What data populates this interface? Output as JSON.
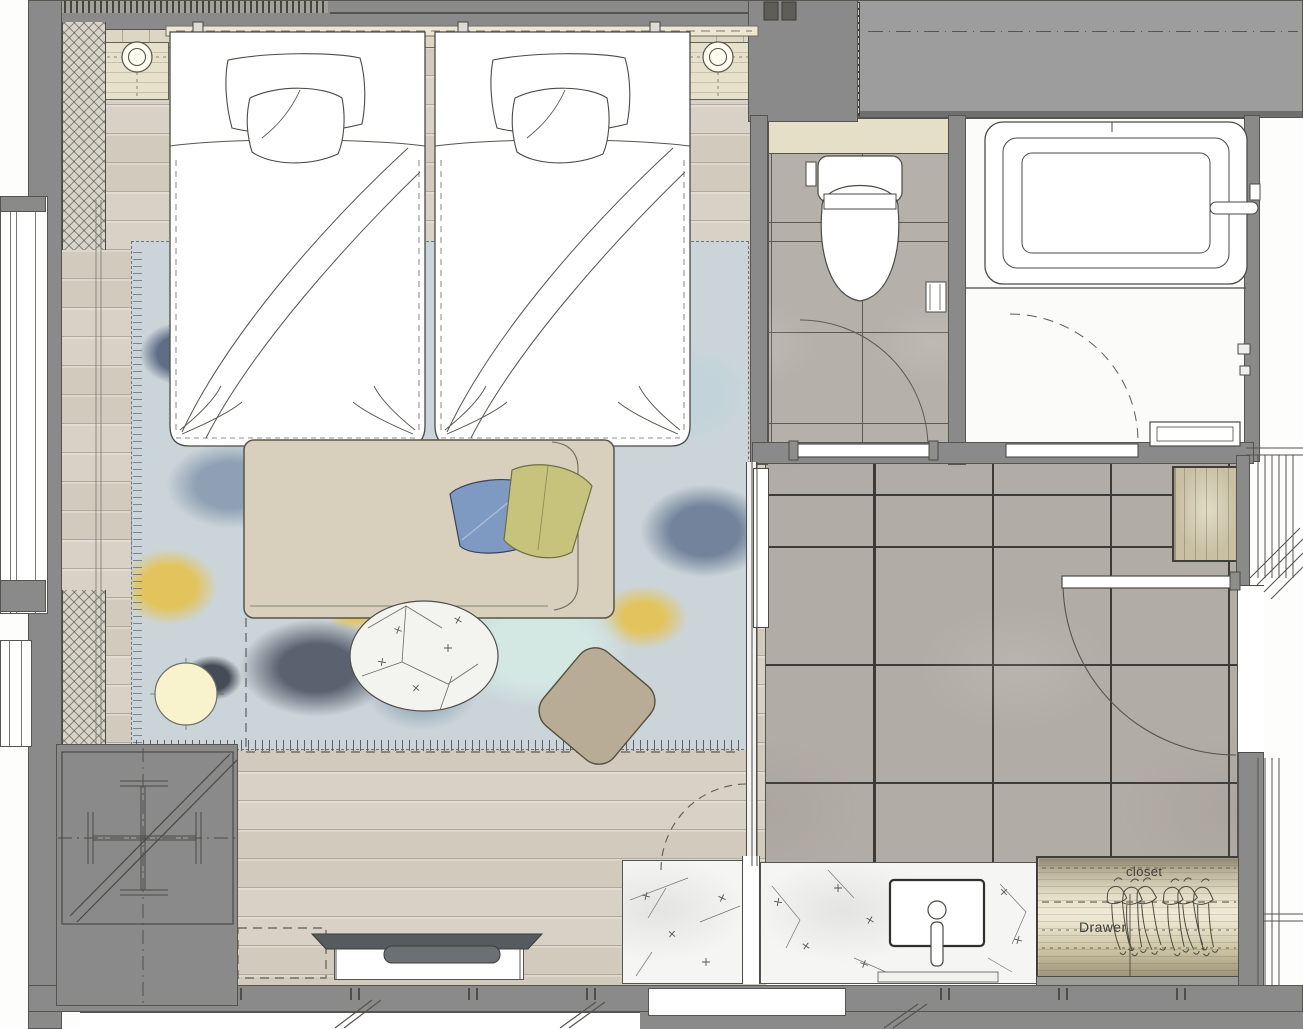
{
  "plan": {
    "kind": "guest-room-floor-plan",
    "labels": {
      "closet": "closet",
      "drawer": "Drawer"
    }
  },
  "colors": {
    "wall": "#8a8a8a",
    "wallLight": "#9d9d9d",
    "wallDark": "#6f6f6f",
    "line": "#4a4a46",
    "wood": "#d8d1c5",
    "woodLine": "#b3aa9b",
    "tile": "#b2aca6",
    "tileLine": "#3c3b38",
    "toiletTile": "#b6b0aa",
    "headboard": "#dcd6c2",
    "nightstand": "#e7e0ca",
    "lamp": "#f8f3cd",
    "rugBase": "#cbd5d9",
    "rugSlate": "#5f6e85",
    "rugDark": "#5a6270",
    "rugYellow": "#e3c35c",
    "rugTeal": "#d4e8e3",
    "daybed": "#d8d0bc",
    "pillowBlue": "#7f9ac2",
    "pillowYellow": "#c8c37c",
    "ottoman": "#b9ac97",
    "marble": "#f5f5f3",
    "closetLight": "#e4ddc6",
    "cabinet": "#c9c0a4",
    "tv": "#565b5f",
    "label": "#3e3e35",
    "beige": "#e6dfc7"
  }
}
